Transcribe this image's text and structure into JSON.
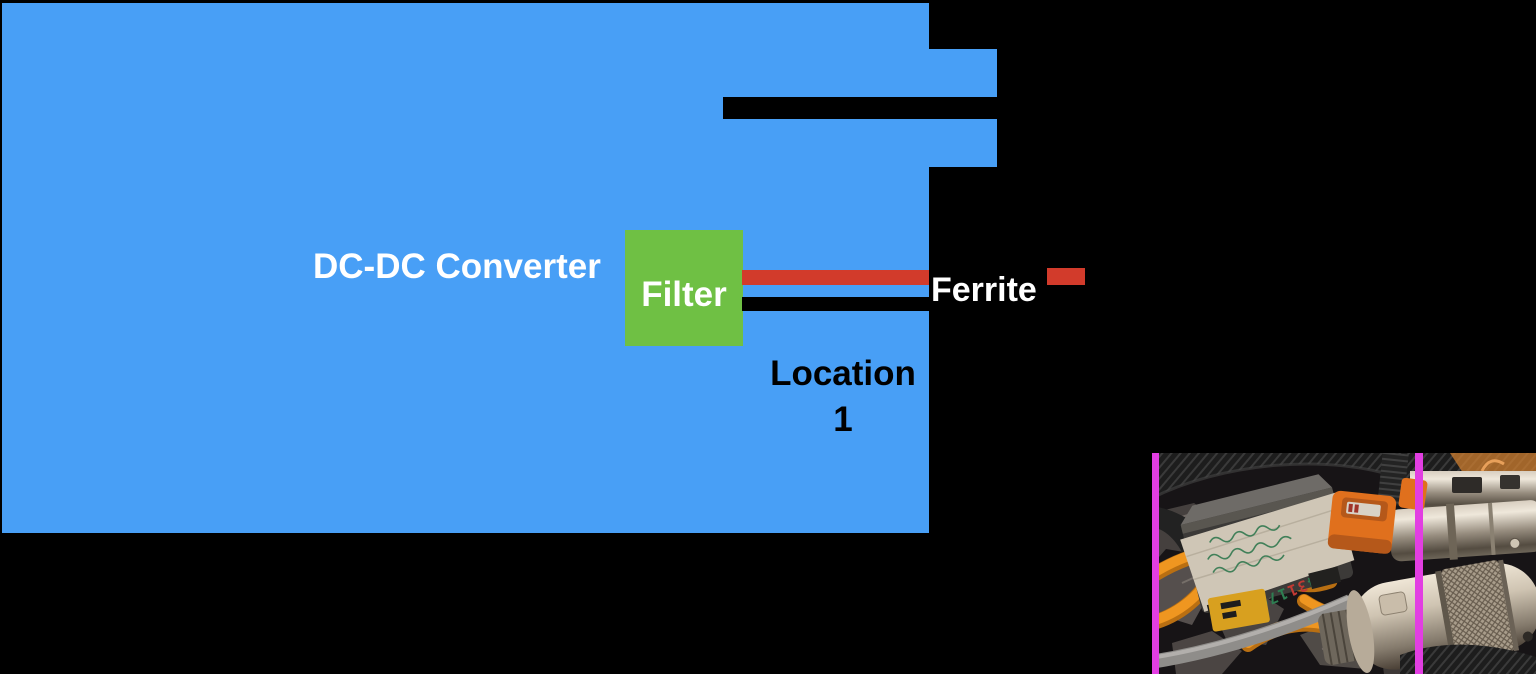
{
  "canvas": {
    "width": 1536,
    "height": 674,
    "background": "#000000"
  },
  "diagram": {
    "converter_label": "DC-DC Converter",
    "filter_label": "Filter",
    "ferrite_label": "Ferrite",
    "location_label_line1": "Location",
    "location_label_line2": "1",
    "colors": {
      "converter_fill": "#489FF6",
      "filter_fill": "#6FC044",
      "wire_positive": "#D23B2B",
      "wire_negative": "#000000",
      "ferrite_bead": "#D23B2B",
      "converter_text": "#FFFFFF",
      "filter_text": "#FFFFFF",
      "ferrite_text": "#FFFFFF",
      "location_text": "#000000"
    }
  },
  "photo_inset": {
    "name": "ferrite-on-cable-photo",
    "marker_color": "#E23EE2",
    "tape_digits_prefix": "04",
    "tape_digits_red": "31",
    "tape_digits_suffix": "176451"
  }
}
